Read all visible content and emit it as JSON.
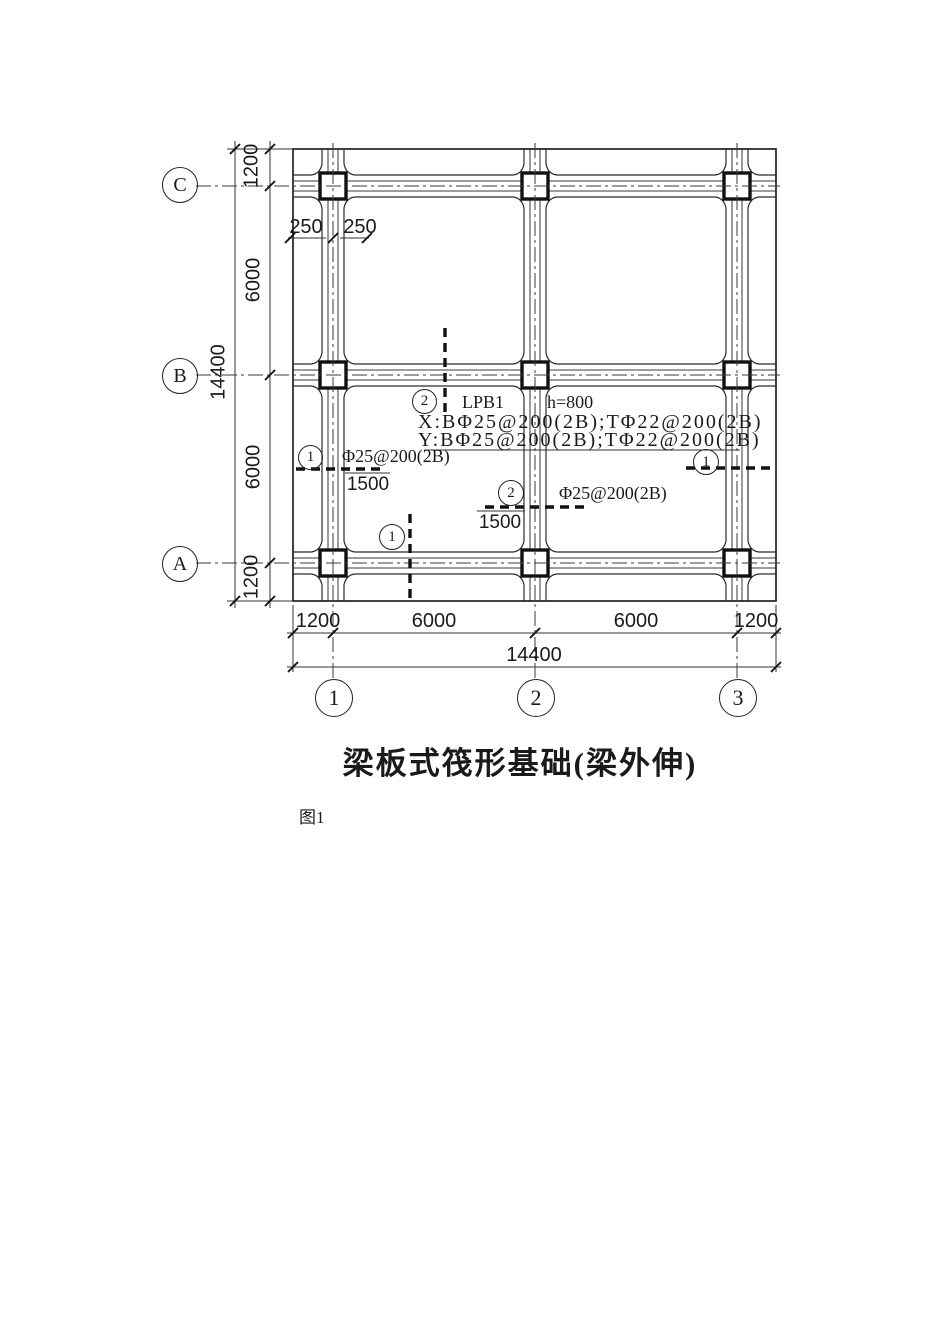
{
  "plan": {
    "title": "梁板式筏形基础(梁外伸)",
    "caption": "图1",
    "axes": {
      "rows": [
        "C",
        "B",
        "A"
      ],
      "cols": [
        "1",
        "2",
        "3"
      ]
    },
    "dims": {
      "left": {
        "segments": [
          "1200",
          "6000",
          "6000",
          "1200"
        ],
        "total": "14400"
      },
      "bottom": {
        "segments": [
          "1200",
          "6000",
          "6000",
          "1200"
        ],
        "total": "14400"
      },
      "beam_offsets": [
        "250",
        "250"
      ]
    },
    "slab": {
      "label": "LPB1",
      "thickness": "h=800",
      "x_rebar": "X:BΦ25@200(2B);TΦ22@200(2B)",
      "y_rebar": "Y:BΦ25@200(2B);TΦ22@200(2B)"
    },
    "sections": {
      "top": {
        "no": "2"
      },
      "left": {
        "no": "1",
        "rebar": "Φ25@200(2B)",
        "extension": "1500"
      },
      "mid": {
        "no": "2",
        "rebar": "Φ25@200(2B)",
        "extension": "1500"
      },
      "right": {
        "no": "1"
      },
      "bottom": {
        "no": "1"
      }
    }
  }
}
